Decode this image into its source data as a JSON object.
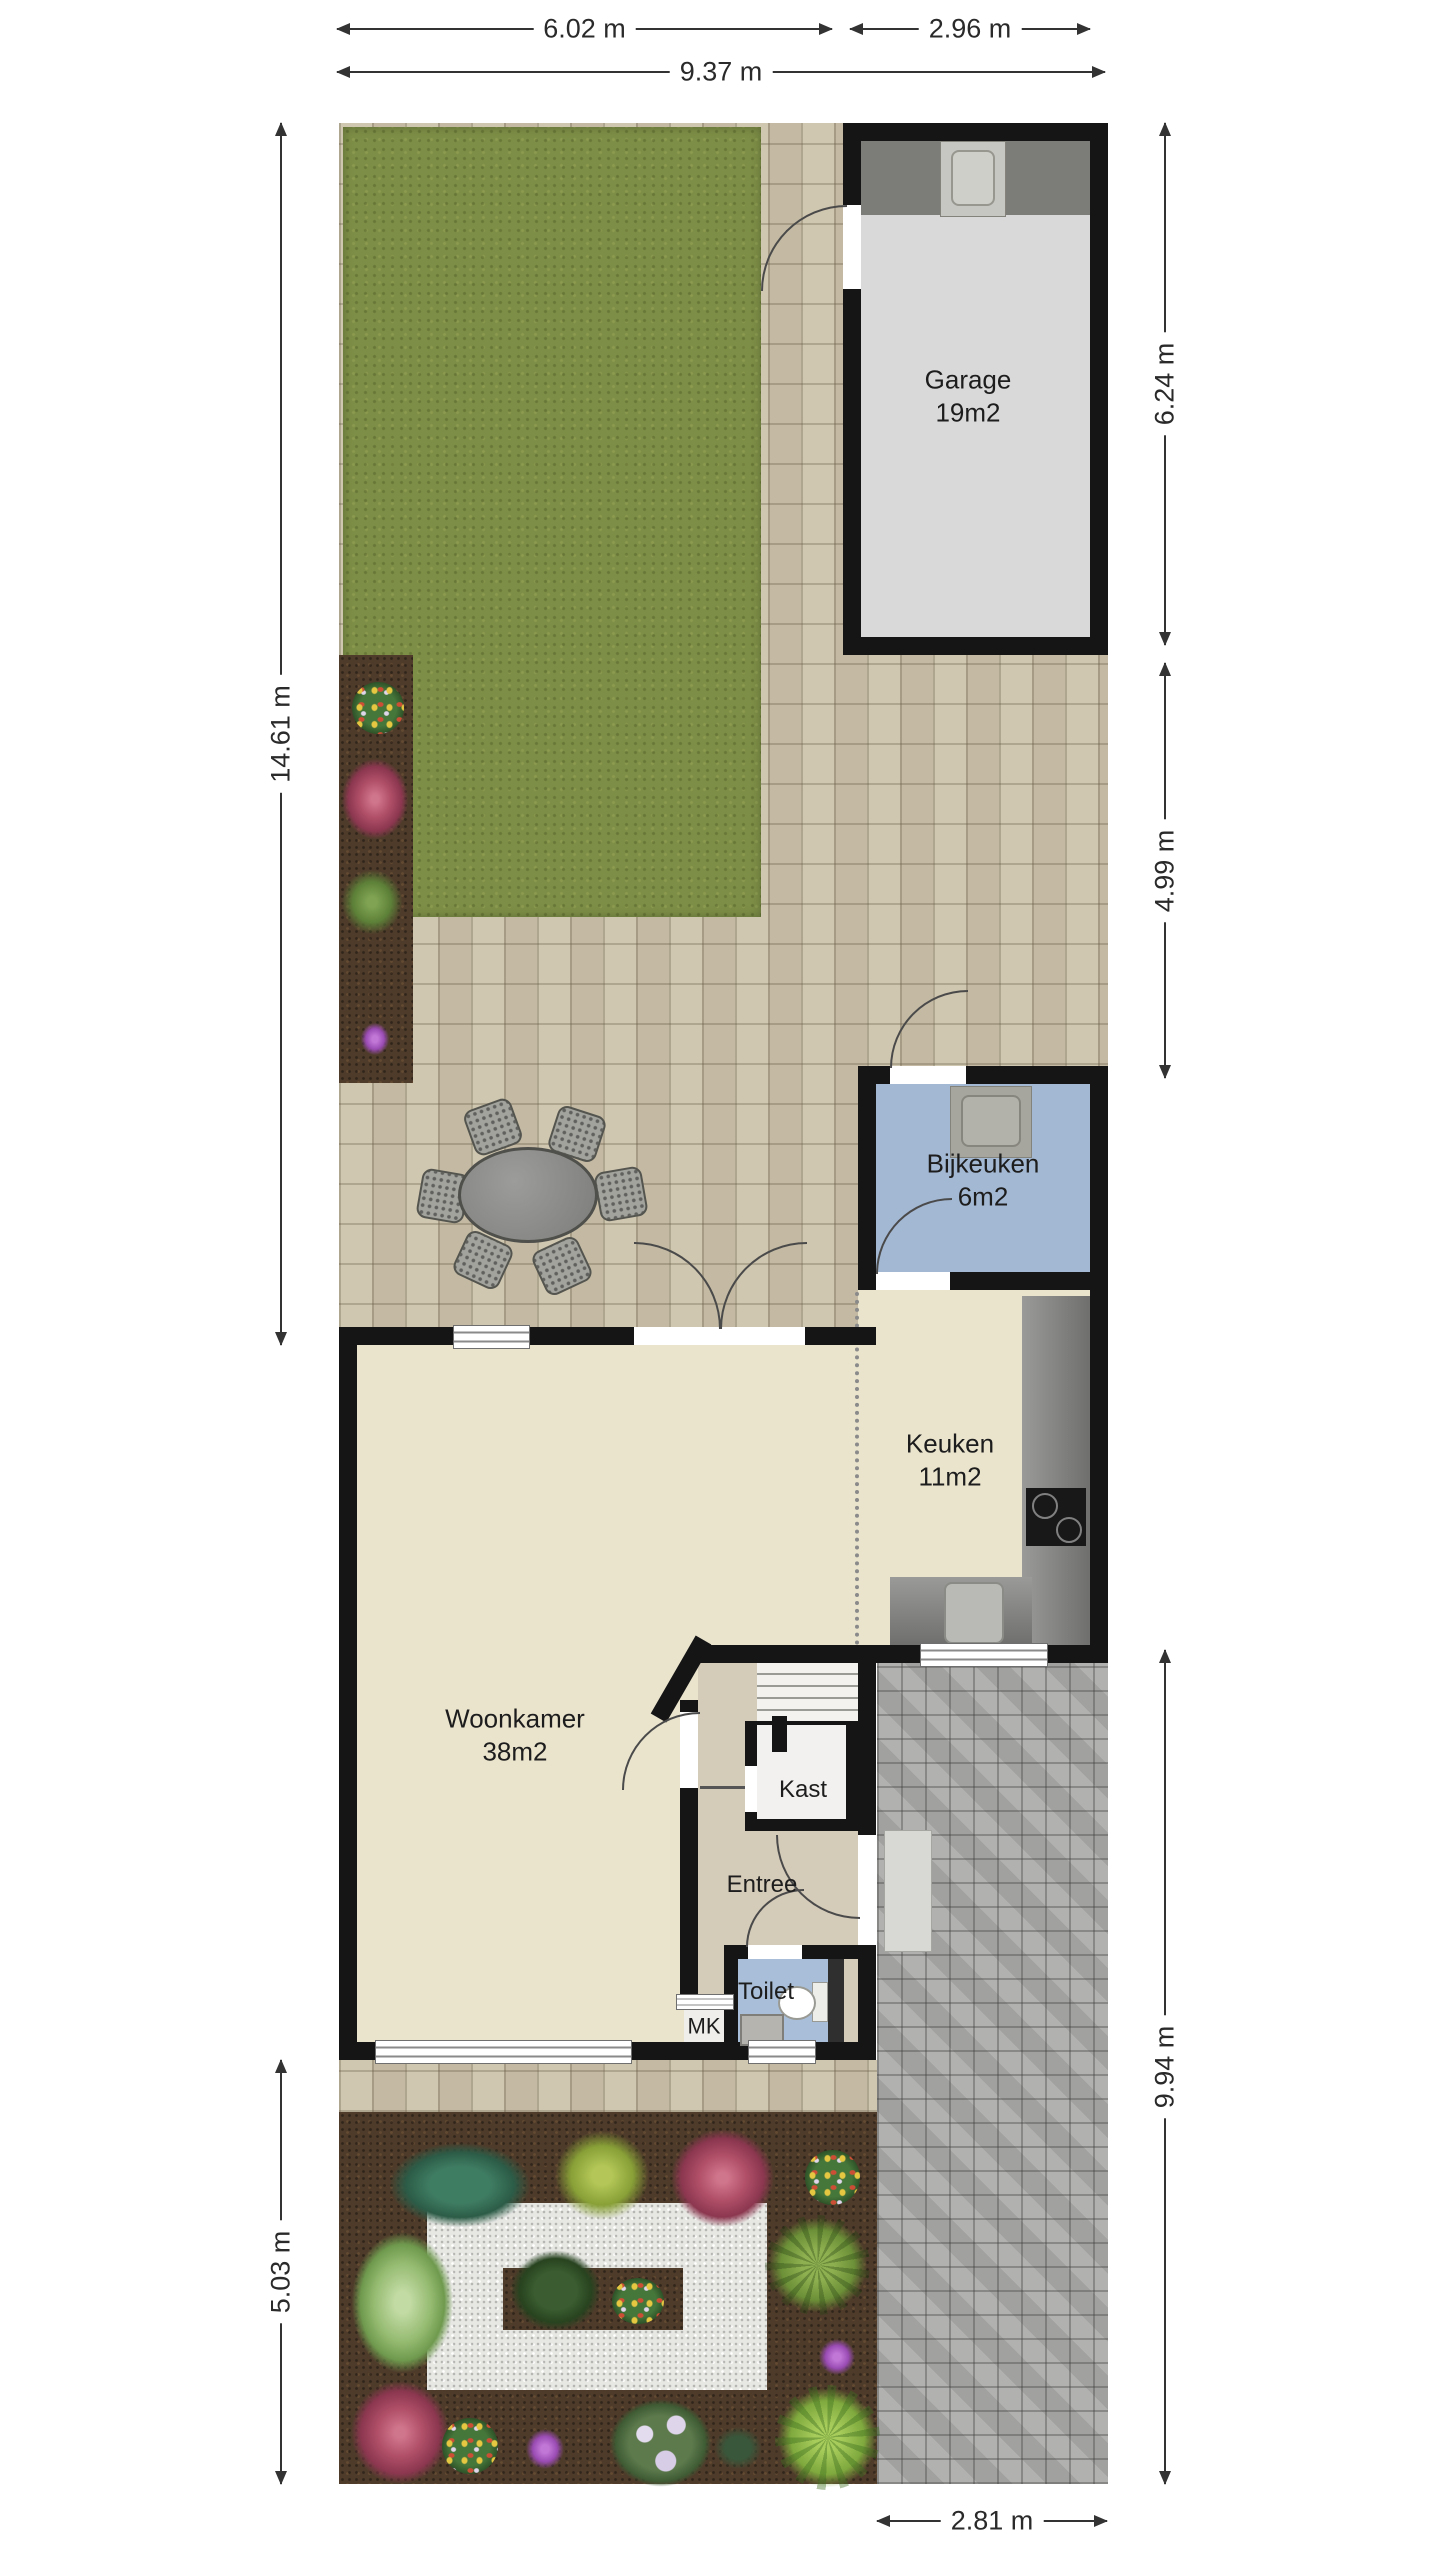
{
  "plan": {
    "rooms": {
      "garage": {
        "name": "Garage",
        "area": "19m2"
      },
      "bijkeuken": {
        "name": "Bijkeuken",
        "area": "6m2"
      },
      "keuken": {
        "name": "Keuken",
        "area": "11m2"
      },
      "woonkamer": {
        "name": "Woonkamer",
        "area": "38m2"
      },
      "kast": {
        "name": "Kast"
      },
      "entree": {
        "name": "Entree"
      },
      "toilet": {
        "name": "Toilet"
      },
      "mk": {
        "name": "MK"
      }
    },
    "dimensions": {
      "top_garden": "6.02 m",
      "top_garage": "2.96 m",
      "top_total": "9.37 m",
      "left_upper": "14.61 m",
      "left_lower": "5.03 m",
      "right_garage": "6.24 m",
      "right_mid": "4.99 m",
      "right_lower": "9.94 m",
      "bottom_driveway": "2.81 m"
    },
    "colors": {
      "wall": "#151515",
      "patio_paving": "#cec4ac",
      "driveway_paving": "#ababa9",
      "grass": "#7d8e46",
      "soil": "#4e3b2a",
      "gravel": "#e7e7e4",
      "living_floor": "#eae4cd",
      "utility_floor": "#a3b8d3",
      "toilet_floor": "#a9bfd9",
      "entry_floor": "#d5cbb9",
      "closet_floor": "#f2f1ef",
      "garage_floor": "#d9d9d9"
    }
  }
}
